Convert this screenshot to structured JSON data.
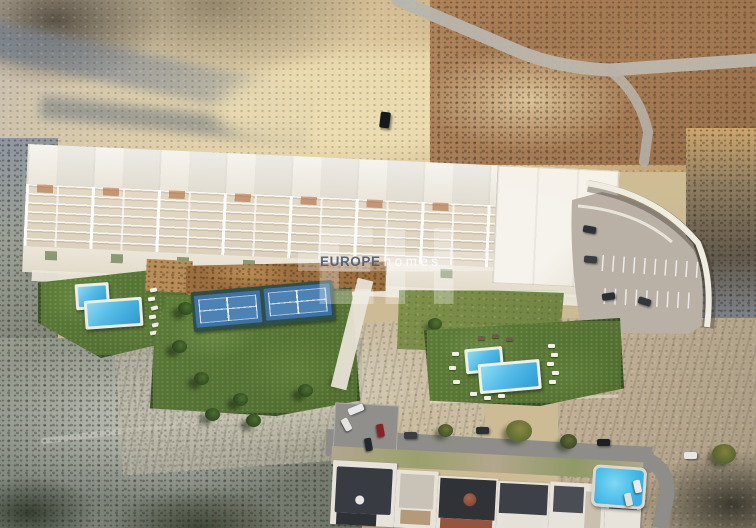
{
  "watermark": {
    "monogram": "EH",
    "brand_bold": "EUROPE",
    "brand_light": "homes"
  },
  "scene": {
    "type": "aerial-render-of-residential-development",
    "features": [
      "terraced-apartment-row",
      "left-l-shaped-pool",
      "paddle-tennis-courts",
      "right-l-shaped-pool",
      "curved-parking-area",
      "existing-street-with-houses",
      "arid-badlands-terrain",
      "dirt-road"
    ]
  },
  "colors": {
    "terrain-tan": "#cdbb95",
    "terrain-cream": "#ead9b0",
    "terrain-shadow": "#97a0a8",
    "scrub-brown": "#a87a52",
    "scrub-green": "#8f948a",
    "roof-white": "#f6f4ef",
    "terrace-beige": "#dcd1bc",
    "pergola-orange": "#b2693a",
    "lawn-green": "#5d7c38",
    "pool-blue": "#3fa8dd",
    "court-blue": "#3e72a6",
    "parking-grey": "#b9b0a6",
    "wall-white": "#efece1",
    "road-grey": "#8e8d89",
    "street-pool-blue": "#35b3e8",
    "watermark-blue": "#4b5a76"
  }
}
